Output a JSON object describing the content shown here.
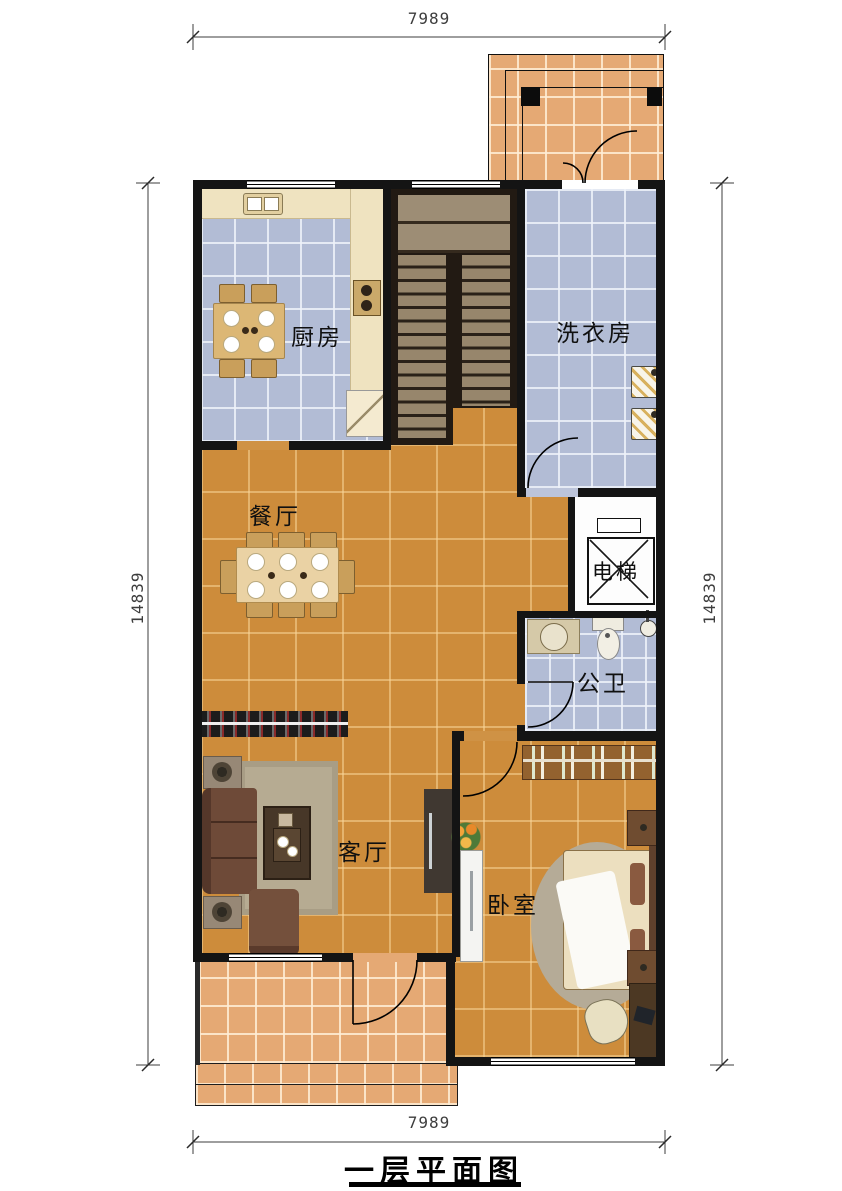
{
  "title": {
    "text": "一层平面图"
  },
  "dimensions": {
    "top": "7989",
    "bottom": "7989",
    "left": "14839",
    "right": "14839"
  },
  "rooms": {
    "kitchen": {
      "label": "厨房"
    },
    "laundry": {
      "label": "洗衣房"
    },
    "dining": {
      "label": "餐厅"
    },
    "elevator": {
      "label": "电梯"
    },
    "bathroom": {
      "label": "公卫"
    },
    "living": {
      "label": "客厅"
    },
    "bedroom": {
      "label": "卧室"
    }
  },
  "colors": {
    "wall": "#141414",
    "tile_main": "#cd8c3b",
    "tile_patio": "#e5a974",
    "tile_wet": "#b2bcd5",
    "counter": "#efe3c0",
    "stair_dark": "#221a13",
    "stair_step": "#97866c"
  }
}
